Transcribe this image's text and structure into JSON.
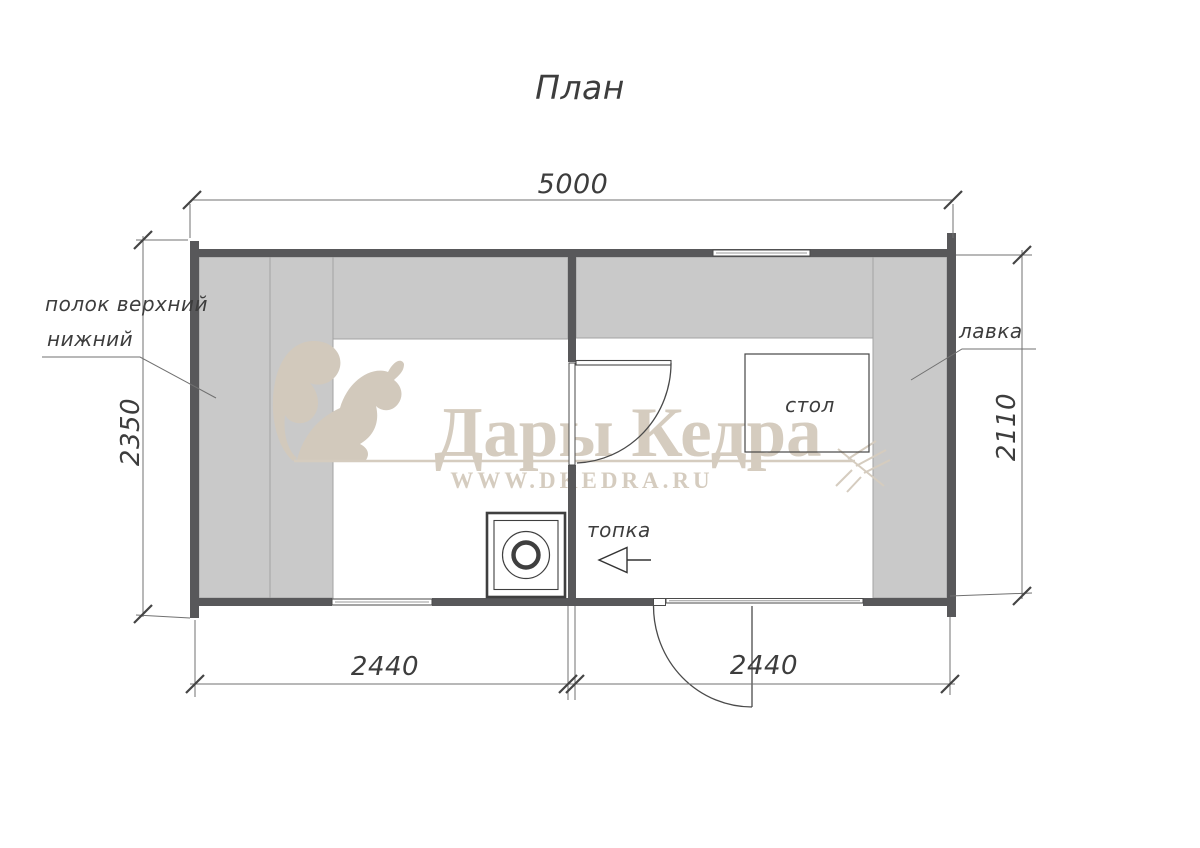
{
  "title": "План",
  "watermark": {
    "brand": "Дары Кедра",
    "site": "WWW.DKEDRA.RU"
  },
  "dimensions": {
    "width_total": "5000",
    "left_height": "2350",
    "right_height": "2110",
    "bottom_left": "2440",
    "bottom_right": "2440"
  },
  "labels": {
    "shelf_upper": "полок верхний",
    "shelf_lower": "нижний",
    "bench": "лавка",
    "table": "стол",
    "firebox": "топка"
  },
  "colors": {
    "wall": "#58585a",
    "platform": "#c9c9c9",
    "platform_edge": "#a3a3a3",
    "line": "#4a4a4a",
    "thin_line": "#707070",
    "ink": "#3d3d3d",
    "watermark": "#d5ccbf",
    "watermark_dark": "#d2c9bc",
    "background": "#ffffff"
  }
}
